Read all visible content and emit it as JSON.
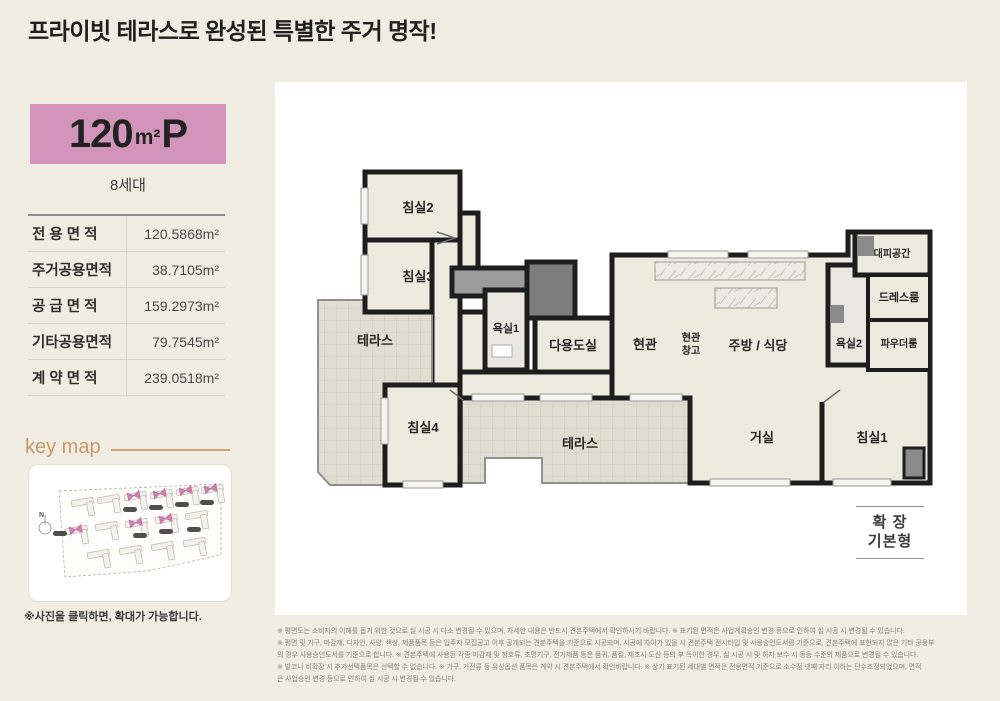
{
  "page": {
    "title": "프라이빗 테라스로 완성된 특별한 주거 명작!"
  },
  "unit": {
    "size_number": "120",
    "size_unit": "m²",
    "size_suffix": "P",
    "households": "8세대"
  },
  "area_table": {
    "rows": [
      {
        "label": "전 용 면 적",
        "value": "120.5868",
        "unit": "m²"
      },
      {
        "label": "주거공용면적",
        "value": "38.7105",
        "unit": "m²"
      },
      {
        "label": "공 급 면 적",
        "value": "159.2973",
        "unit": "m²"
      },
      {
        "label": "기타공용면적",
        "value": "79.7545",
        "unit": "m²"
      },
      {
        "label": "계 약 면 적",
        "value": "239.0518",
        "unit": "m²"
      }
    ]
  },
  "key_map": {
    "heading": "key map",
    "compass": "N",
    "note": "※사진을 클릭하면, 확대가 가능합니다."
  },
  "floor_plan": {
    "rooms": {
      "bed2": "침실2",
      "bed3": "침실3",
      "terrace_left": "테라스",
      "bed4": "침실4",
      "bath1": "욕실1",
      "utility": "다용도실",
      "entry": "현관",
      "entry_storage_line1": "현관",
      "entry_storage_line2": "창고",
      "kitchen": "주방 / 식당",
      "refuge": "대피공간",
      "dress": "드레스룸",
      "bath2": "욕실2",
      "powder": "파우더룸",
      "terrace_bottom": "테라스",
      "living": "거실",
      "bed1": "침실1"
    },
    "legend": {
      "line1": "확 장",
      "line2": "기본형"
    }
  },
  "disclaimer": {
    "lines": [
      "※ 평면도는 소비자의 이해를 돕기 위한 것으로 실 시공 시 다소 변경될 수 있으며, 자세한 내용은 반드시 견본주택에서 확인하시기 바랍니다. ※ 표기된 면적은 사업계획승인 변경 등으로 인하여 실 시공 시 변경될 수 있습니다.",
      "※ 평면 및 가구, 마감재, 디자인, 사양, 색상, 제품품목 등은 입주자 모집공고 이후 공개되는 견본주택을 기준으로 시공되며, 시공에 차이가 있을 시 견본주택 전시타입 및 사용승인도서를 기준으로, 견본주택에 표현되지 않은 기타 공용부",
      "의 경우 사용승인도서를 기준으로 합니다. ※ 견본주택에 사용된 각종 마감재 및 창호류, 조명기구, 전기제품 등은 품귀, 품절, 제조사 도산 등의 부 득이한 경우, 실 시공 시 및 하자 보수 시 동등 수준의 제품으로 변경될 수 있습니다.",
      "※ 발코니 비확장 시 추가선택품목은 선택할 수 없습니다. ※ 가구, 가전류 등 유상옵션 품목은 계약 시 견본주택에서 확인바랍니다. ※ 상기 표기된 세대별 면적은 전용면적 기준으로 소수점 넷째 자리 이하는 단수조정되었으며, 면적",
      "은 사업승인 변경 등으로 인하여 실 시공 시 변경될 수 있습니다."
    ]
  },
  "colors": {
    "background": "#f2ede3",
    "accent_pink": "#d394bc",
    "keymap_heading": "#c49a6c",
    "keymap_highlight": "#cf7fb1",
    "wall": "#1d1d1d"
  }
}
